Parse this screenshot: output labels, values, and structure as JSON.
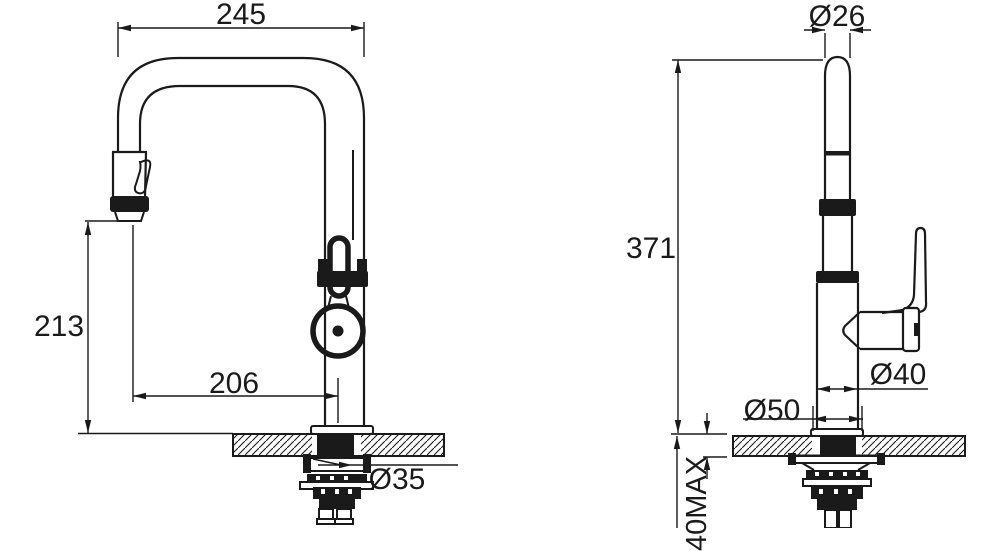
{
  "title": "faucet-technical-drawing",
  "colors": {
    "line": "#1a1a1a",
    "background": "#ffffff"
  },
  "side_view": {
    "dim_width": "245",
    "dim_height": "213",
    "dim_reach": "206",
    "dim_shank": "Ø35"
  },
  "front_view": {
    "dim_spout": "Ø26",
    "dim_total_height": "371",
    "dim_base": "Ø50",
    "dim_body": "Ø40",
    "dim_counter_max": "40MAX"
  }
}
